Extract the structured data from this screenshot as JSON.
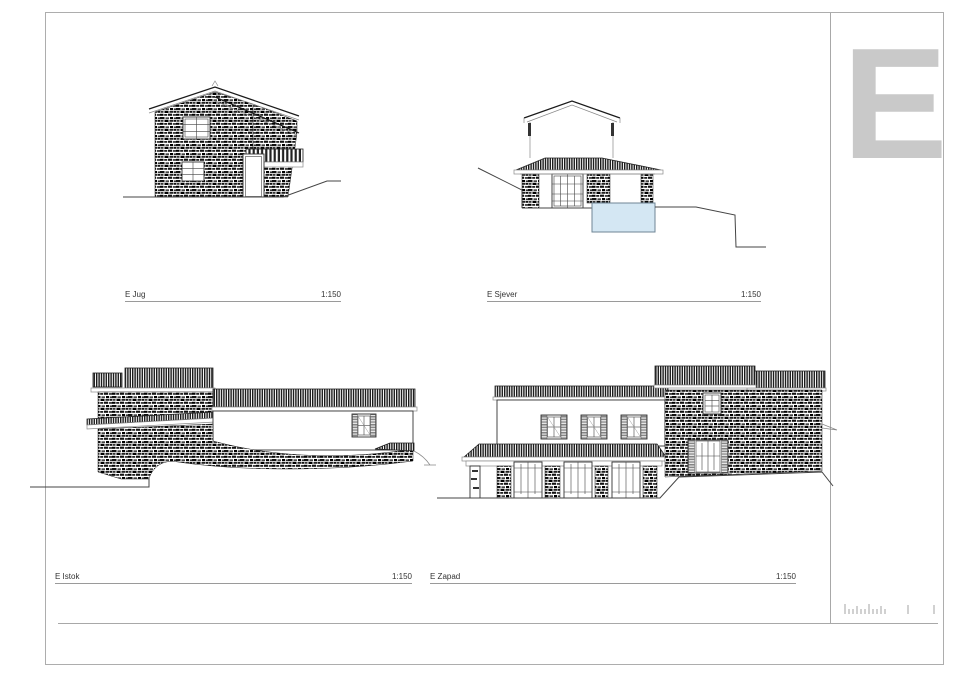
{
  "sheet": {
    "revision_letter": "E",
    "elevations": [
      {
        "id": "jug",
        "label": "E Jug",
        "scale": "1:150"
      },
      {
        "id": "sjever",
        "label": "E Sjever",
        "scale": "1:150"
      },
      {
        "id": "istok",
        "label": "E Istok",
        "scale": "1:150"
      },
      {
        "id": "zapad",
        "label": "E Zapad",
        "scale": "1:150"
      }
    ],
    "colors": {
      "pool_fill": "#d4e7f3",
      "pool_stroke": "#6f8696",
      "revision_letter_color": "#c9c9c9",
      "frame_line": "#adadad",
      "ink": "#1a1a1a"
    }
  }
}
